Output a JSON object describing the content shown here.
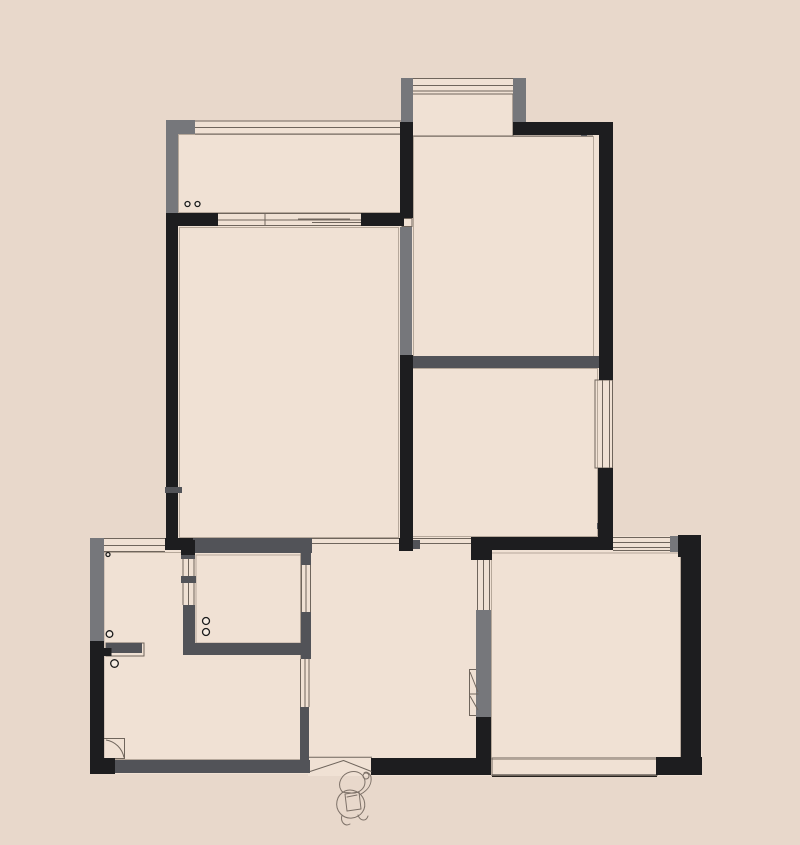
{
  "canvas": {
    "width": 800,
    "height": 845,
    "background": "#e8d8cb",
    "floor": "#f0e1d4"
  },
  "palette": {
    "black": "#1d1d1f",
    "gray": "#76777b",
    "dgray": "#525358",
    "line": "#6f655c",
    "outline": "#9b8d80",
    "sketch": "#7d7168",
    "dark_edge": "#26221f"
  },
  "floorplan": {
    "floors": [
      [
        178,
        121,
        224,
        105
      ],
      [
        401,
        78,
        125,
        58
      ],
      [
        402,
        122,
        211,
        246
      ],
      [
        166,
        213,
        246,
        338
      ],
      [
        399,
        356,
        214,
        195
      ],
      [
        90,
        538,
        222,
        236
      ],
      [
        308,
        537,
        184,
        239
      ],
      [
        471,
        536,
        231,
        240
      ]
    ],
    "outlines": [
      [
        179.5,
        227.5,
        219,
        310
      ],
      [
        413.5,
        136.5,
        180,
        220
      ],
      [
        412.5,
        368.5,
        185,
        168
      ],
      [
        491.5,
        553,
        189,
        206.5
      ],
      [
        104,
        552.5,
        196.5,
        207
      ],
      [
        196,
        555,
        105,
        88
      ],
      [
        178.5,
        134.5,
        222.5,
        78
      ]
    ],
    "walls_black": [
      [
        166,
        213,
        12,
        274
      ],
      [
        166,
        493,
        12,
        45
      ],
      [
        165,
        538,
        28,
        12
      ],
      [
        166,
        213,
        52,
        13
      ],
      [
        361,
        213,
        43,
        13
      ],
      [
        400,
        122,
        13,
        96
      ],
      [
        400,
        355,
        13,
        190
      ],
      [
        399,
        538,
        14,
        13
      ],
      [
        513,
        122,
        100,
        13
      ],
      [
        599,
        122,
        14,
        258
      ],
      [
        598,
        468,
        15,
        70
      ],
      [
        471,
        537,
        142,
        13
      ],
      [
        471,
        537,
        21,
        23
      ],
      [
        678,
        535,
        22,
        22
      ],
      [
        681,
        535,
        20,
        239
      ],
      [
        656,
        757,
        46,
        18
      ],
      [
        476,
        717,
        15,
        58
      ],
      [
        371,
        758,
        111,
        17
      ],
      [
        90,
        641,
        14,
        133
      ],
      [
        90,
        758,
        25,
        16
      ],
      [
        181,
        540,
        14,
        15
      ],
      [
        103.5,
        648,
        8,
        8
      ]
    ],
    "walls_gray": [
      [
        166,
        120,
        29,
        14
      ],
      [
        166,
        120,
        12,
        93
      ],
      [
        401,
        78,
        12,
        44
      ],
      [
        513,
        78,
        13,
        44
      ],
      [
        400,
        227,
        12,
        128
      ],
      [
        90,
        538,
        14,
        103
      ],
      [
        476,
        610,
        15,
        107
      ],
      [
        670,
        536,
        10,
        16
      ]
    ],
    "walls_dgray": [
      [
        412,
        356,
        187,
        12
      ],
      [
        193,
        538,
        119,
        15
      ],
      [
        301,
        553,
        10,
        12
      ],
      [
        301,
        612,
        10,
        47
      ],
      [
        300,
        707,
        9,
        53
      ],
      [
        183,
        643,
        122,
        12
      ],
      [
        183,
        605,
        12,
        50
      ],
      [
        108,
        760,
        202,
        13
      ],
      [
        106,
        643,
        36,
        10
      ],
      [
        165,
        487,
        17,
        6
      ],
      [
        181,
        553,
        14,
        6
      ],
      [
        181,
        576,
        15,
        7
      ],
      [
        581,
        123,
        6,
        13
      ],
      [
        597,
        523,
        16,
        6
      ],
      [
        477,
        548,
        15,
        9
      ],
      [
        412,
        540,
        8,
        9
      ]
    ],
    "window_lines": [
      [
        195,
        121,
        401,
        121
      ],
      [
        195,
        127.5,
        401,
        127.5
      ],
      [
        195,
        134,
        401,
        134
      ],
      [
        218,
        213.5,
        361,
        213.5
      ],
      [
        218,
        220,
        361,
        220
      ],
      [
        218,
        225.5,
        361,
        225.5
      ],
      [
        265,
        213.5,
        265,
        225.5
      ],
      [
        298,
        219,
        350,
        219
      ],
      [
        312,
        222.5,
        361,
        222.5
      ],
      [
        413,
        78.5,
        513,
        78.5
      ],
      [
        413,
        85.5,
        513,
        85.5
      ],
      [
        413,
        91,
        513,
        91
      ],
      [
        413,
        136,
        593,
        136
      ],
      [
        602.5,
        380,
        602.5,
        468
      ],
      [
        609.5,
        380,
        609.5,
        468
      ],
      [
        613,
        537.5,
        670,
        537.5
      ],
      [
        613,
        542.5,
        670,
        542.5
      ],
      [
        613,
        547.5,
        670,
        547.5
      ],
      [
        613,
        550.5,
        670,
        550.5
      ],
      [
        477.5,
        560,
        477.5,
        610
      ],
      [
        483.5,
        560,
        483.5,
        610
      ],
      [
        489.5,
        560,
        489.5,
        610
      ],
      [
        183,
        559,
        183,
        605
      ],
      [
        188.5,
        559,
        188.5,
        605
      ],
      [
        194,
        559,
        194,
        605
      ],
      [
        301.5,
        565,
        301.5,
        612
      ],
      [
        306,
        565,
        306,
        612
      ],
      [
        310.5,
        565,
        310.5,
        612
      ],
      [
        300.5,
        659,
        300.5,
        707
      ],
      [
        305,
        659,
        305,
        707
      ],
      [
        309,
        659,
        309,
        707
      ],
      [
        103,
        538.5,
        165,
        538.5
      ],
      [
        103,
        545.5,
        165,
        545.5
      ],
      [
        103,
        551.5,
        165,
        551.5
      ],
      [
        310,
        538.5,
        472,
        538.5
      ],
      [
        310,
        543.5,
        472,
        543.5
      ],
      [
        309,
        757.3,
        372,
        757.3
      ],
      [
        492,
        758,
        657,
        758
      ]
    ],
    "heavy_lines": [
      [
        492,
        775.8,
        657,
        775.8
      ]
    ],
    "frames": [
      [
        409,
        94,
        104,
        42
      ],
      [
        402,
        218.5,
        10,
        8
      ],
      [
        595,
        380,
        17.5,
        88
      ],
      [
        469.5,
        669.5,
        9,
        46
      ],
      [
        106,
        643,
        38,
        13
      ],
      [
        103.5,
        738.5,
        21,
        20
      ],
      [
        492,
        758,
        165,
        17.5
      ]
    ],
    "circles": [
      [
        187.5,
        204,
        2.5
      ],
      [
        197.5,
        204,
        2.5
      ],
      [
        206,
        621,
        3.5
      ],
      [
        206,
        632,
        3.5
      ],
      [
        108,
        554.5,
        2
      ],
      [
        109.5,
        634,
        3.3
      ],
      [
        114.5,
        663.5,
        3.8
      ]
    ],
    "fixture_paths": [
      "M310,771.5 L343.5,760.5 L371.5,771.5",
      "M106,740 C115,741.5 122,748 124,757.5",
      "M470,672 L478,692",
      "M469.5,694 L478.5,694",
      "M470,696 L478,710"
    ],
    "person_paths": [
      "M341,790 C337,783 342,774 350,772 C358,770 365,775 365,782 C365,789 358,794 351,793 C347,792 343,794 341,790 Z",
      "M337,801 C335,811 343,819 352,818 C361,817 367,809 364,800 C361,792 352,788 345,791 C341,793 338,796 337,801 Z",
      "M345,794 L359,792 L361,809 L347,811 Z",
      "M347,797 L357,795",
      "M361,794 C368,790 372,784 371,777 C370,773 366,771 364,773",
      "M363,776 a3,3 0 1 0 6,0 a3,3 0 1 0 -6,0",
      "M342,815 C340,822 345,827 350,824",
      "M358,815 C360,821 366,822 368,816"
    ]
  }
}
